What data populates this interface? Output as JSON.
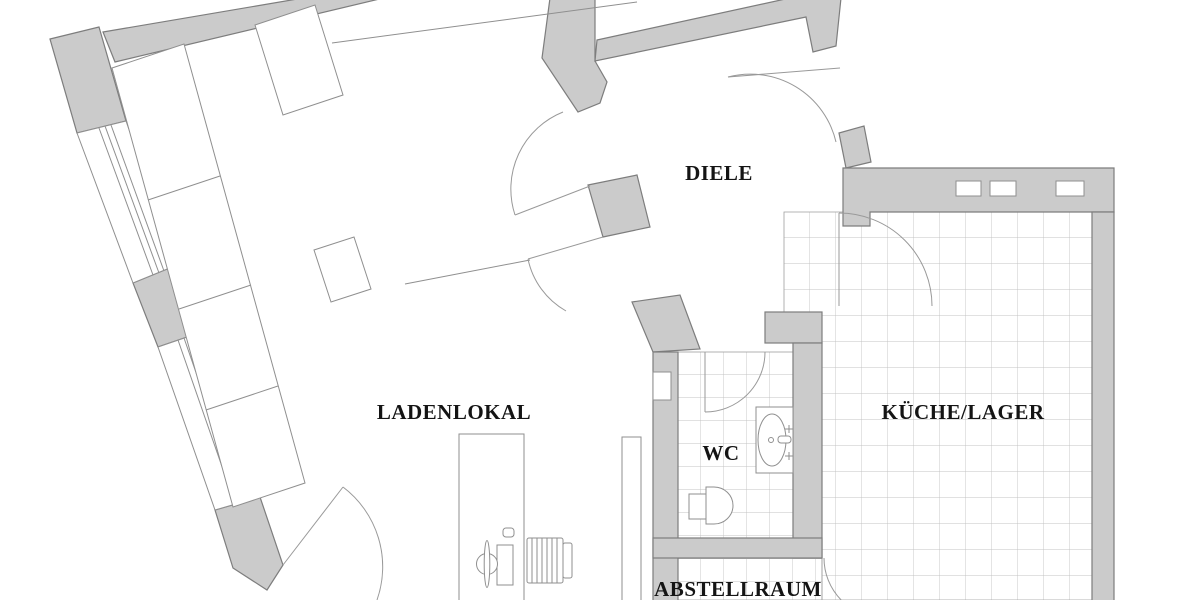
{
  "document": {
    "type": "architectural-floor-plan",
    "background_color": "#ffffff",
    "width_px": 1200,
    "height_px": 600
  },
  "colors": {
    "wall_fill": "#cbcbcb",
    "wall_stroke": "#7d7d7d",
    "thin_line": "#8f8f8f",
    "door_arc": "#999999",
    "tile_line": "#c3c3c3",
    "label_text": "#141414"
  },
  "rooms": [
    {
      "id": "diele",
      "label": "DIELE",
      "x": 719,
      "y": 180
    },
    {
      "id": "ladenlokal",
      "label": "LADENLOKAL",
      "x": 454,
      "y": 419
    },
    {
      "id": "kueche_lager",
      "label": "KÜCHE/LAGER",
      "x": 963,
      "y": 419
    },
    {
      "id": "wc",
      "label": "WC",
      "x": 721,
      "y": 460
    },
    {
      "id": "abstellraum",
      "label": "ABSTELLRAUM",
      "x": 738,
      "y": 596
    }
  ],
  "features": {
    "doors": [
      "diele-to-ladenlokal-upper",
      "diele-to-ladenlokal-lower",
      "apartment-entrance",
      "kitchen-door",
      "wc-door",
      "shop-entrance",
      "abstellraum-door"
    ],
    "fixtures": [
      "sink",
      "toilet",
      "desk",
      "office-chair",
      "drawer-cabinet",
      "display-shelf-long",
      "display-shelf-top",
      "display-table"
    ],
    "windows": [
      "shopfront-window-upper",
      "shopfront-window-lower",
      "kitchen-window-1",
      "kitchen-window-2",
      "kitchen-window-3",
      "wc-niche"
    ]
  }
}
